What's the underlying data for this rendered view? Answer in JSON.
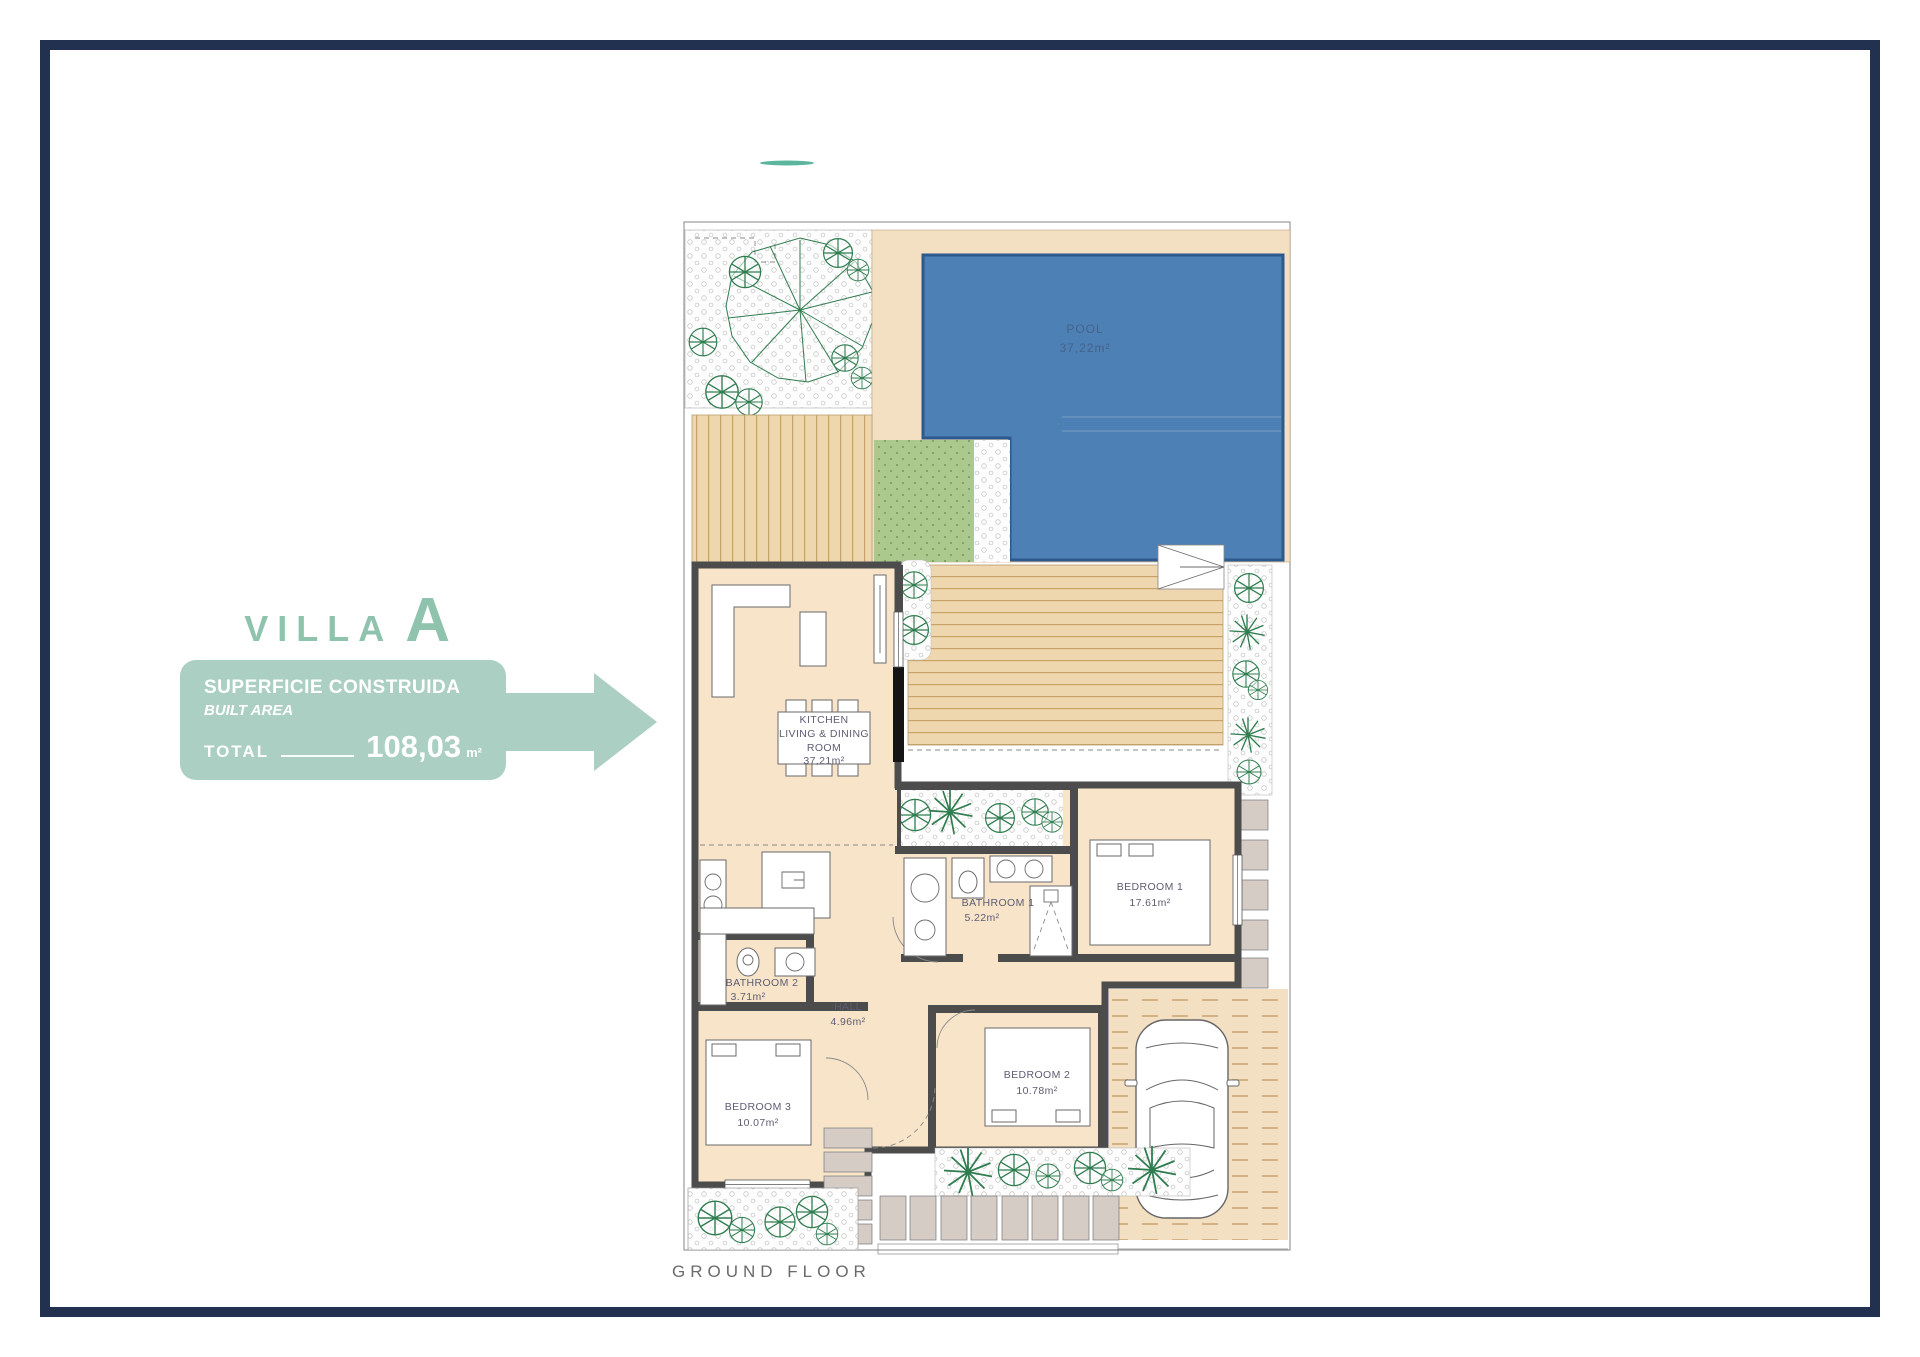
{
  "villa": {
    "name_prefix": "VILLA",
    "name_letter": "A",
    "accent_color": "#8fc3ad"
  },
  "info_box": {
    "title": "SUPERFICIE CONSTRUIDA",
    "subtitle": "BUILT AREA",
    "total_label": "TOTAL",
    "total_value": "108,03",
    "total_unit": "m²",
    "bg_color": "#abcfc2"
  },
  "plan": {
    "floor_label": "GROUND FLOOR",
    "rooms": [
      {
        "id": "pool",
        "name": "POOL",
        "area": "37,22m²"
      },
      {
        "id": "kitchen_living_dining",
        "name_lines": [
          "KITCHEN",
          "LIVING & DINING",
          "ROOM"
        ],
        "area": "37,21m²"
      },
      {
        "id": "bathroom1",
        "name": "BATHROOM 1",
        "area": "5.22m²"
      },
      {
        "id": "bedroom1",
        "name": "BEDROOM 1",
        "area": "17.61m²"
      },
      {
        "id": "bathroom2",
        "name": "BATHROOM 2",
        "area": "3.71m²"
      },
      {
        "id": "hall",
        "name": "HALL",
        "area": "4.96m²"
      },
      {
        "id": "bedroom2",
        "name": "BEDROOM 2",
        "area": "10.78m²"
      },
      {
        "id": "bedroom3",
        "name": "BEDROOM 3",
        "area": "10.07m²"
      }
    ],
    "colors": {
      "pool": "#4d80b4",
      "deck": "#eed7ae",
      "floor": "#f7e4c9",
      "grass": "#abc98c",
      "wall": "#4c4c4c",
      "plant": "#2f7d4f"
    }
  }
}
